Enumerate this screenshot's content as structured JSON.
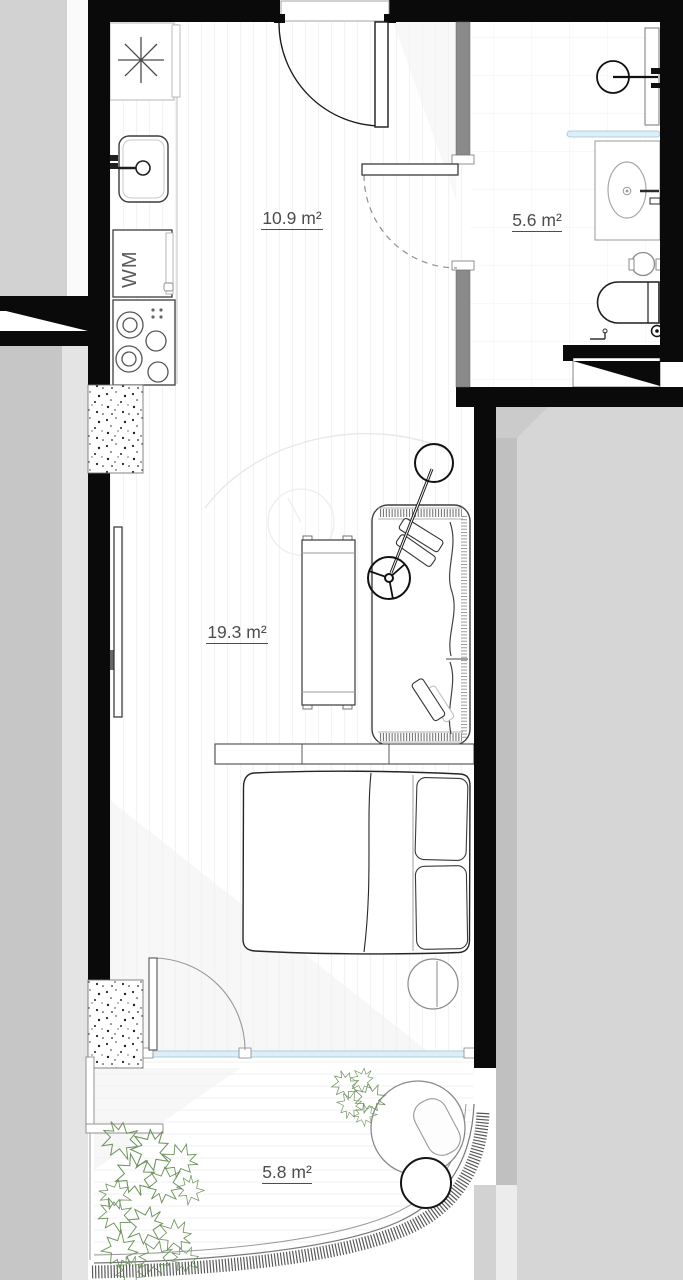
{
  "plan": {
    "type": "apartment-floor-plan",
    "rooms": [
      {
        "name": "kitchen-entry",
        "area_label": "10.9 m²"
      },
      {
        "name": "bathroom",
        "area_label": "5.6 m²"
      },
      {
        "name": "living-sleeping-room",
        "area_label": "19.3 m²"
      },
      {
        "name": "balcony",
        "area_label": "5.8 m²"
      }
    ],
    "appliance_labels": {
      "washing_machine": "WM"
    },
    "icons": [
      "freezer-asterisk-icon",
      "sink-faucet-icon",
      "cooktop-burners-icon",
      "shower-head-icon",
      "washbasin-icon",
      "toilet-icon",
      "floor-drain-icon",
      "door-swing-arc",
      "plant-leaves-icon"
    ],
    "colors": {
      "wall_black": "#0a0a0a",
      "partition_gray": "#8a8a8a",
      "neighbor_mass": "#d4d4d4",
      "glass_blue": "#ddeef8",
      "glass_blue_stroke": "#9cc4da",
      "plant_green": "#6f925f",
      "label_text": "#4d4d4d"
    }
  }
}
